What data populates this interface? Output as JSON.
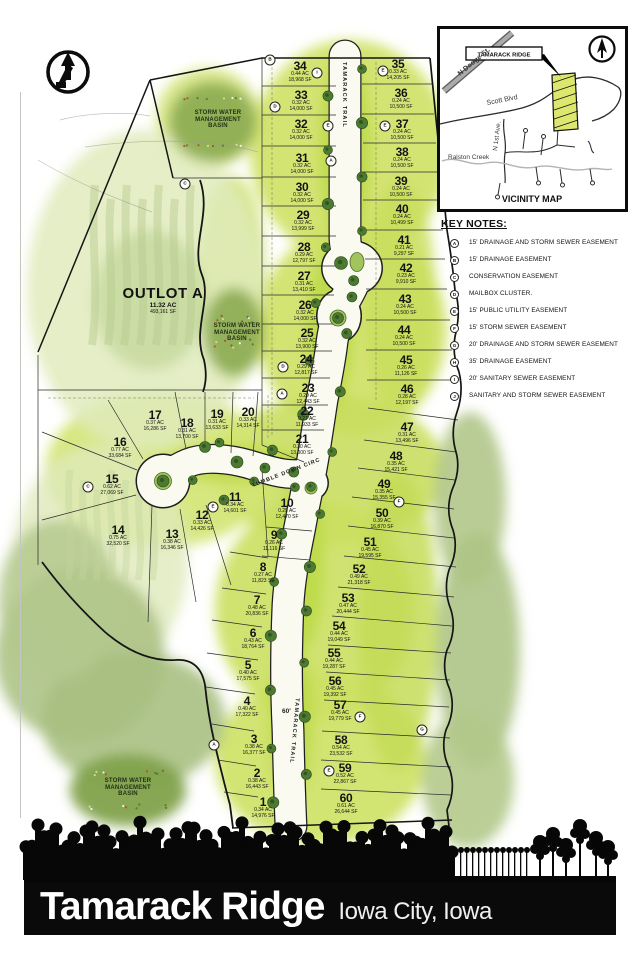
{
  "sheet": {
    "title": "Tamarack Ridge",
    "subtitle": "Iowa City, Iowa"
  },
  "vicinity": {
    "title": "VICINITY MAP",
    "site_label": "TAMARACK RIDGE",
    "road_n_dodge": "N Dodge St.",
    "road_scott": "Scott Blvd",
    "road_n_1st": "N 1st Ave.",
    "creek": "Ralston Creek"
  },
  "key_notes": {
    "title": "KEY NOTES:",
    "items": [
      {
        "key": "A",
        "text": "15' DRAINAGE AND STORM SEWER EASEMENT"
      },
      {
        "key": "B",
        "text": "15' DRAINAGE EASEMENT"
      },
      {
        "key": "C",
        "text": "CONSERVATION EASEMENT"
      },
      {
        "key": "D",
        "text": "MAILBOX CLUSTER."
      },
      {
        "key": "E",
        "text": "15' PUBLIC UTILITY EASEMENT"
      },
      {
        "key": "F",
        "text": "15' STORM SEWER EASEMENT"
      },
      {
        "key": "G",
        "text": "20' DRAINAGE AND STORM SEWER EASEMENT"
      },
      {
        "key": "H",
        "text": "35' DRAINAGE EASEMENT"
      },
      {
        "key": "I",
        "text": "20' SANITARY SEWER EASEMENT"
      },
      {
        "key": "J",
        "text": "SANITARY AND STORM SEWER EASEMENT"
      }
    ]
  },
  "map": {
    "outlot": {
      "name": "OUTLOT A",
      "ac": "11.32 AC",
      "sf": "493,161 SF"
    },
    "basin_label_lines": [
      "STORM WATER",
      "MANAGEMENT",
      "BASIN"
    ],
    "basins": [
      {
        "x": 218,
        "y": 120
      },
      {
        "x": 237,
        "y": 333
      },
      {
        "x": 128,
        "y": 788
      }
    ],
    "streets": {
      "trail": "TAMARACK TRAIL",
      "circle": "TUMBLE DOWN CIRC",
      "width_label": "60'"
    },
    "lots": [
      {
        "n": "1",
        "ac": "0.34 AC",
        "sf": "14,976 SF",
        "x": 263,
        "y": 807
      },
      {
        "n": "2",
        "ac": "0.38 AC",
        "sf": "16,443 SF",
        "x": 257,
        "y": 778
      },
      {
        "n": "3",
        "ac": "0.38 AC",
        "sf": "16,377 SF",
        "x": 254,
        "y": 744
      },
      {
        "n": "4",
        "ac": "0.40 AC",
        "sf": "17,322 SF",
        "x": 247,
        "y": 706
      },
      {
        "n": "5",
        "ac": "0.40 AC",
        "sf": "17,575 SF",
        "x": 248,
        "y": 670
      },
      {
        "n": "6",
        "ac": "0.43 AC",
        "sf": "18,764 SF",
        "x": 253,
        "y": 638
      },
      {
        "n": "7",
        "ac": "0.48 AC",
        "sf": "20,836 SF",
        "x": 257,
        "y": 605
      },
      {
        "n": "8",
        "ac": "0.27 AC",
        "sf": "11,823 SF",
        "x": 263,
        "y": 572
      },
      {
        "n": "9",
        "ac": "0.26 AC",
        "sf": "11,116 SF",
        "x": 274,
        "y": 540
      },
      {
        "n": "10",
        "ac": "0.29 AC",
        "sf": "12,470 SF",
        "x": 287,
        "y": 508
      },
      {
        "n": "11",
        "ac": "0.34 AC",
        "sf": "14,601 SF",
        "x": 235,
        "y": 502
      },
      {
        "n": "12",
        "ac": "0.33 AC",
        "sf": "14,426 SF",
        "x": 202,
        "y": 520
      },
      {
        "n": "13",
        "ac": "0.38 AC",
        "sf": "16,346 SF",
        "x": 172,
        "y": 539
      },
      {
        "n": "14",
        "ac": "0.75 AC",
        "sf": "32,520 SF",
        "x": 118,
        "y": 535
      },
      {
        "n": "15",
        "ac": "0.62 AC",
        "sf": "27,069 SF",
        "x": 112,
        "y": 484
      },
      {
        "n": "16",
        "ac": "0.77 AC",
        "sf": "33,684 SF",
        "x": 120,
        "y": 447
      },
      {
        "n": "17",
        "ac": "0.37 AC",
        "sf": "16,286 SF",
        "x": 155,
        "y": 420
      },
      {
        "n": "18",
        "ac": "0.31 AC",
        "sf": "13,700 SF",
        "x": 187,
        "y": 428
      },
      {
        "n": "19",
        "ac": "0.31 AC",
        "sf": "13,633 SF",
        "x": 217,
        "y": 419
      },
      {
        "n": "20",
        "ac": "0.33 AC",
        "sf": "14,314 SF",
        "x": 248,
        "y": 417
      },
      {
        "n": "21",
        "ac": "0.30 AC",
        "sf": "13,000 SF",
        "x": 302,
        "y": 444
      },
      {
        "n": "22",
        "ac": "0.27 AC",
        "sf": "11,933 SF",
        "x": 307,
        "y": 416
      },
      {
        "n": "23",
        "ac": "0.29 AC",
        "sf": "12,443 SF",
        "x": 308,
        "y": 393
      },
      {
        "n": "24",
        "ac": "0.29 AC",
        "sf": "12,817 SF",
        "x": 306,
        "y": 364
      },
      {
        "n": "25",
        "ac": "0.32 AC",
        "sf": "13,900 SF",
        "x": 307,
        "y": 338
      },
      {
        "n": "26",
        "ac": "0.32 AC",
        "sf": "14,000 SF",
        "x": 305,
        "y": 310
      },
      {
        "n": "27",
        "ac": "0.31 AC",
        "sf": "13,410 SF",
        "x": 304,
        "y": 281
      },
      {
        "n": "28",
        "ac": "0.29 AC",
        "sf": "12,797 SF",
        "x": 304,
        "y": 252
      },
      {
        "n": "29",
        "ac": "0.32 AC",
        "sf": "13,999 SF",
        "x": 303,
        "y": 220
      },
      {
        "n": "30",
        "ac": "0.32 AC",
        "sf": "14,000 SF",
        "x": 302,
        "y": 192
      },
      {
        "n": "31",
        "ac": "0.32 AC",
        "sf": "14,000 SF",
        "x": 302,
        "y": 163
      },
      {
        "n": "32",
        "ac": "0.32 AC",
        "sf": "14,000 SF",
        "x": 301,
        "y": 129
      },
      {
        "n": "33",
        "ac": "0.32 AC",
        "sf": "14,000 SF",
        "x": 301,
        "y": 100
      },
      {
        "n": "34",
        "ac": "0.44 AC",
        "sf": "18,968 SF",
        "x": 300,
        "y": 71
      },
      {
        "n": "35",
        "ac": "0.33 AC",
        "sf": "14,205 SF",
        "x": 398,
        "y": 69
      },
      {
        "n": "36",
        "ac": "0.24 AC",
        "sf": "10,500 SF",
        "x": 401,
        "y": 98
      },
      {
        "n": "37",
        "ac": "0.24 AC",
        "sf": "10,500 SF",
        "x": 402,
        "y": 129
      },
      {
        "n": "38",
        "ac": "0.24 AC",
        "sf": "10,500 SF",
        "x": 402,
        "y": 157
      },
      {
        "n": "39",
        "ac": "0.24 AC",
        "sf": "10,500 SF",
        "x": 401,
        "y": 186
      },
      {
        "n": "40",
        "ac": "0.24 AC",
        "sf": "10,499 SF",
        "x": 402,
        "y": 214
      },
      {
        "n": "41",
        "ac": "0.21 AC",
        "sf": "9,297 SF",
        "x": 404,
        "y": 245
      },
      {
        "n": "42",
        "ac": "0.23 AC",
        "sf": "9,910 SF",
        "x": 406,
        "y": 273
      },
      {
        "n": "43",
        "ac": "0.24 AC",
        "sf": "10,500 SF",
        "x": 405,
        "y": 304
      },
      {
        "n": "44",
        "ac": "0.24 AC",
        "sf": "10,500 SF",
        "x": 404,
        "y": 335
      },
      {
        "n": "45",
        "ac": "0.26 AC",
        "sf": "11,126 SF",
        "x": 406,
        "y": 365
      },
      {
        "n": "46",
        "ac": "0.28 AC",
        "sf": "12,197 SF",
        "x": 407,
        "y": 394
      },
      {
        "n": "47",
        "ac": "0.31 AC",
        "sf": "13,496 SF",
        "x": 407,
        "y": 432
      },
      {
        "n": "48",
        "ac": "0.35 AC",
        "sf": "15,421 SF",
        "x": 396,
        "y": 461
      },
      {
        "n": "49",
        "ac": "0.35 AC",
        "sf": "15,355 SF",
        "x": 384,
        "y": 489
      },
      {
        "n": "50",
        "ac": "0.39 AC",
        "sf": "16,870 SF",
        "x": 382,
        "y": 518
      },
      {
        "n": "51",
        "ac": "0.45 AC",
        "sf": "19,595 SF",
        "x": 370,
        "y": 547
      },
      {
        "n": "52",
        "ac": "0.49 AC",
        "sf": "21,318 SF",
        "x": 359,
        "y": 574
      },
      {
        "n": "53",
        "ac": "0.47 AC",
        "sf": "20,444 SF",
        "x": 348,
        "y": 603
      },
      {
        "n": "54",
        "ac": "0.44 AC",
        "sf": "19,049 SF",
        "x": 339,
        "y": 631
      },
      {
        "n": "55",
        "ac": "0.44 AC",
        "sf": "19,287 SF",
        "x": 334,
        "y": 658
      },
      {
        "n": "56",
        "ac": "0.45 AC",
        "sf": "19,392 SF",
        "x": 335,
        "y": 686
      },
      {
        "n": "57",
        "ac": "0.45 AC",
        "sf": "19,779 SF",
        "x": 340,
        "y": 710
      },
      {
        "n": "58",
        "ac": "0.54 AC",
        "sf": "23,532 SF",
        "x": 341,
        "y": 745
      },
      {
        "n": "59",
        "ac": "0.52 AC",
        "sf": "22,867 SF",
        "x": 345,
        "y": 773
      },
      {
        "n": "60",
        "ac": "0.61 AC",
        "sf": "26,644 SF",
        "x": 346,
        "y": 803
      }
    ],
    "key_markers": [
      {
        "k": "B",
        "x": 270,
        "y": 60
      },
      {
        "k": "I",
        "x": 317,
        "y": 73
      },
      {
        "k": "E",
        "x": 383,
        "y": 71
      },
      {
        "k": "D",
        "x": 275,
        "y": 107
      },
      {
        "k": "E",
        "x": 328,
        "y": 126
      },
      {
        "k": "E",
        "x": 385,
        "y": 126
      },
      {
        "k": "A",
        "x": 331,
        "y": 161
      },
      {
        "k": "C",
        "x": 185,
        "y": 184
      },
      {
        "k": "D",
        "x": 283,
        "y": 367
      },
      {
        "k": "A",
        "x": 282,
        "y": 394
      },
      {
        "k": "C",
        "x": 88,
        "y": 487
      },
      {
        "k": "E",
        "x": 213,
        "y": 507
      },
      {
        "k": "F",
        "x": 399,
        "y": 502
      },
      {
        "k": "F",
        "x": 360,
        "y": 717
      },
      {
        "k": "G",
        "x": 422,
        "y": 730
      },
      {
        "k": "E",
        "x": 329,
        "y": 771
      },
      {
        "k": "A",
        "x": 214,
        "y": 745
      }
    ]
  }
}
